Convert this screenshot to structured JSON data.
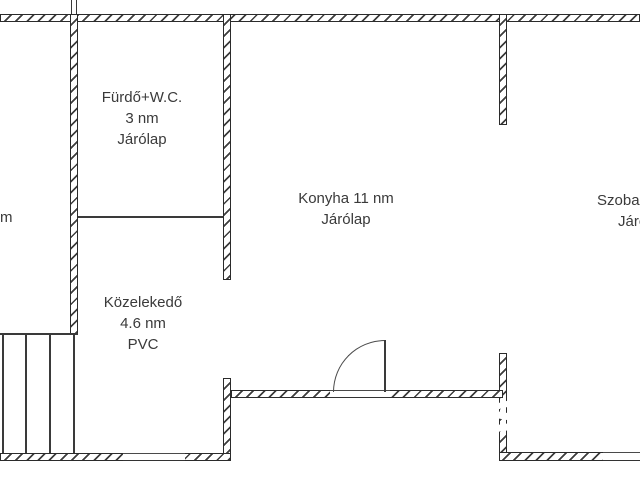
{
  "rooms": {
    "bathroom": {
      "name": "Fürdő+W.C.",
      "area": "3 nm",
      "floor": "Járólap"
    },
    "kitchen": {
      "name_area": "Konyha 11 nm",
      "floor": "Járólap"
    },
    "hallway": {
      "name": "Közelekedő",
      "area": "4.6 nm",
      "floor": "PVC"
    },
    "room_right": {
      "name": "Szoba",
      "floor": "Járólap"
    },
    "room_left_partial": {
      "text": "m"
    }
  },
  "colors": {
    "wall_line": "#2b2b2b",
    "text": "#3a3a3a",
    "background": "#ffffff"
  }
}
